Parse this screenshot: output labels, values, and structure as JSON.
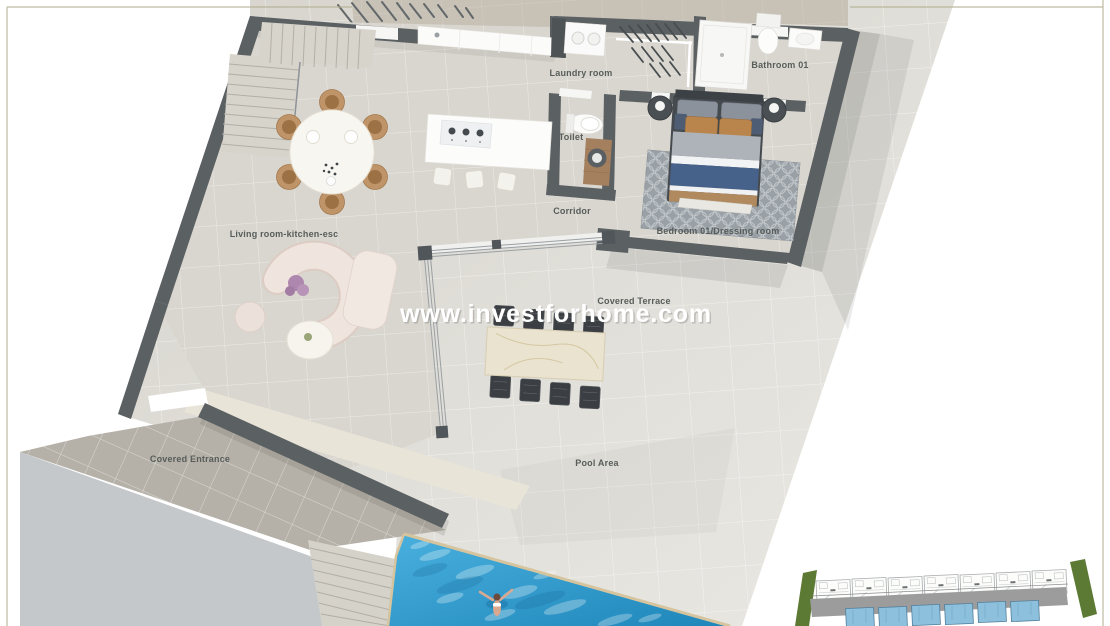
{
  "watermark": "www.investforhome.com",
  "rooms": {
    "laundry": "Laundry room",
    "bathroom": "Bathroom 01",
    "toilet": "Toilet",
    "corridor": "Corridor",
    "bedroom": "Bedroom 01/Dressing room",
    "living": "Living room-kitchen-esc",
    "terrace": "Covered Terrace",
    "entrance": "Covered Entrance",
    "pool_area": "Pool Area"
  },
  "colors": {
    "wall": "#5b6063",
    "interior_floor": "#d9d6cf",
    "deck": "#dcdad4",
    "top_strip": "#c7c1b6",
    "entrance_tiles": "#b6b1a8",
    "driveway": "#c5c8ca",
    "canopy": "#e8e4d8",
    "pool": "#2f9fd1",
    "pool_coping": "#d6c49e",
    "site_green": "#5d7a35",
    "site_road": "#9c9c9c",
    "site_pool": "#8cc0dc",
    "label_text": "#575d5a",
    "watermark_text": "#ffffff"
  }
}
